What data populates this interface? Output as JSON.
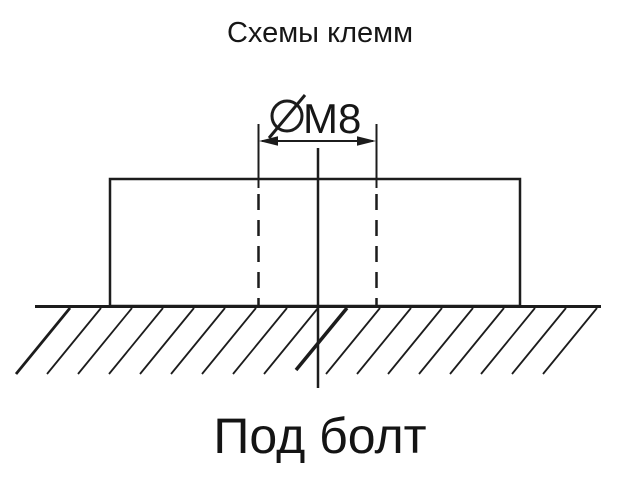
{
  "colors": {
    "background": "#ffffff",
    "ink": "#1c1c1c"
  },
  "title": "Схемы клемм",
  "dimension": {
    "symbol_icon": "diameter-icon",
    "label": "M8"
  },
  "caption": "Под болт"
}
